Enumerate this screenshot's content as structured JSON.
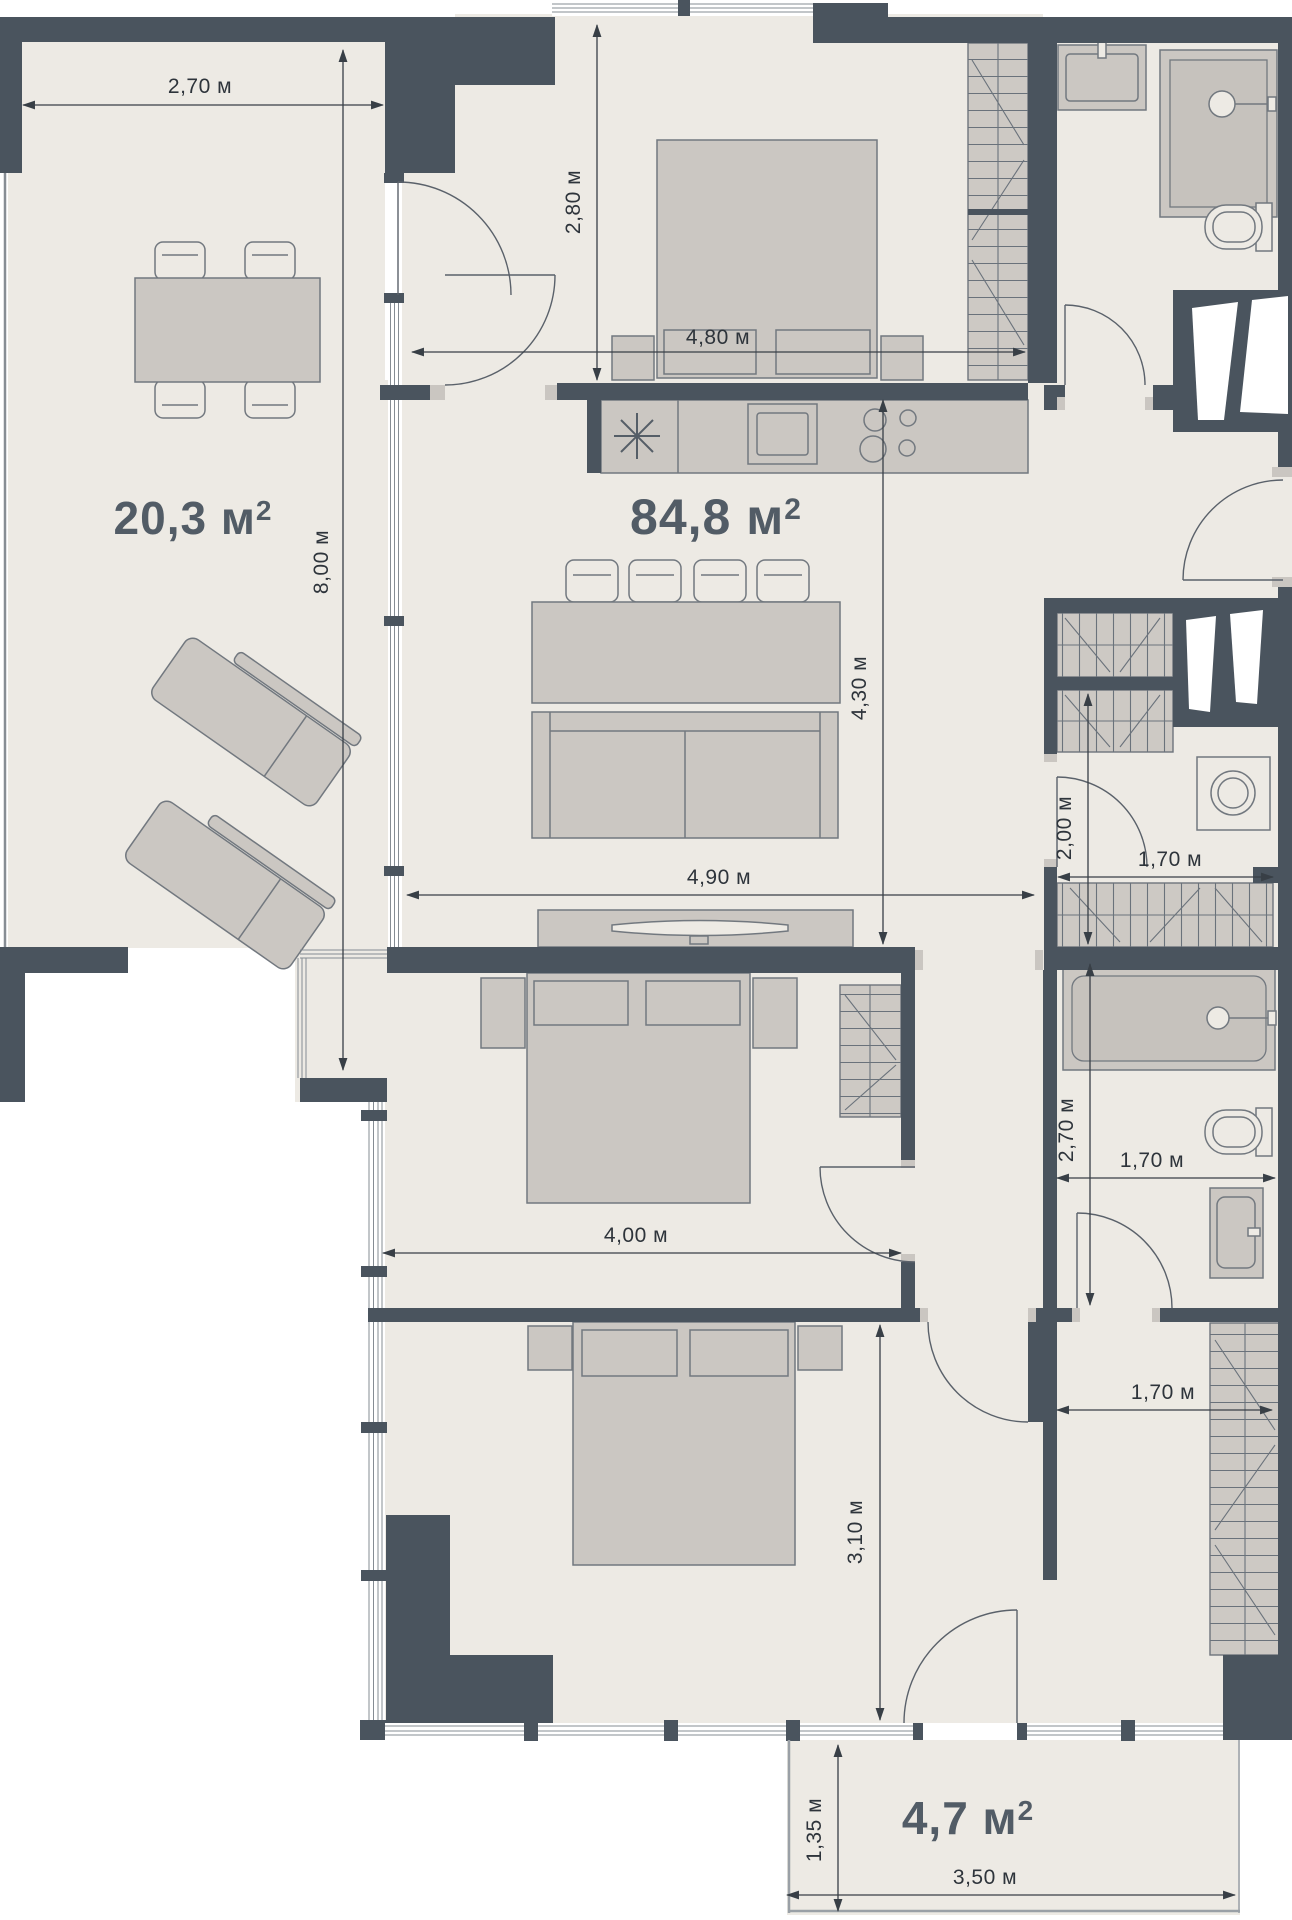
{
  "plan": {
    "type": "apartment-floor-plan",
    "units": "м"
  },
  "areas": {
    "terrace": {
      "value": "20,3 м",
      "sup": "2"
    },
    "living": {
      "value": "84,8 м",
      "sup": "2"
    },
    "balcony": {
      "value": "4,7 м",
      "sup": "2"
    }
  },
  "dims": {
    "terrace_w": "2,70 м",
    "terrace_h": "8,00 м",
    "bedroom1_h": "2,80 м",
    "bedroom1_w": "4,80 м",
    "living_h": "4,30 м",
    "living_w": "4,90 м",
    "laundry_h": "2,00 м",
    "laundry_w": "1,70 м",
    "bath_h": "2,70 м",
    "bath_w": "1,70 м",
    "bedroom2_w": "4,00 м",
    "bedroom3_h": "3,10 м",
    "hall_w": "1,70 м",
    "balcony_h": "1,35 м",
    "balcony_w": "3,50 м"
  },
  "colors": {
    "wall": "#4a545e",
    "floor": "#edeae4",
    "furniture": "#cbc7c2",
    "dimension_text": "#2e343b",
    "area_label": "#525c66"
  }
}
